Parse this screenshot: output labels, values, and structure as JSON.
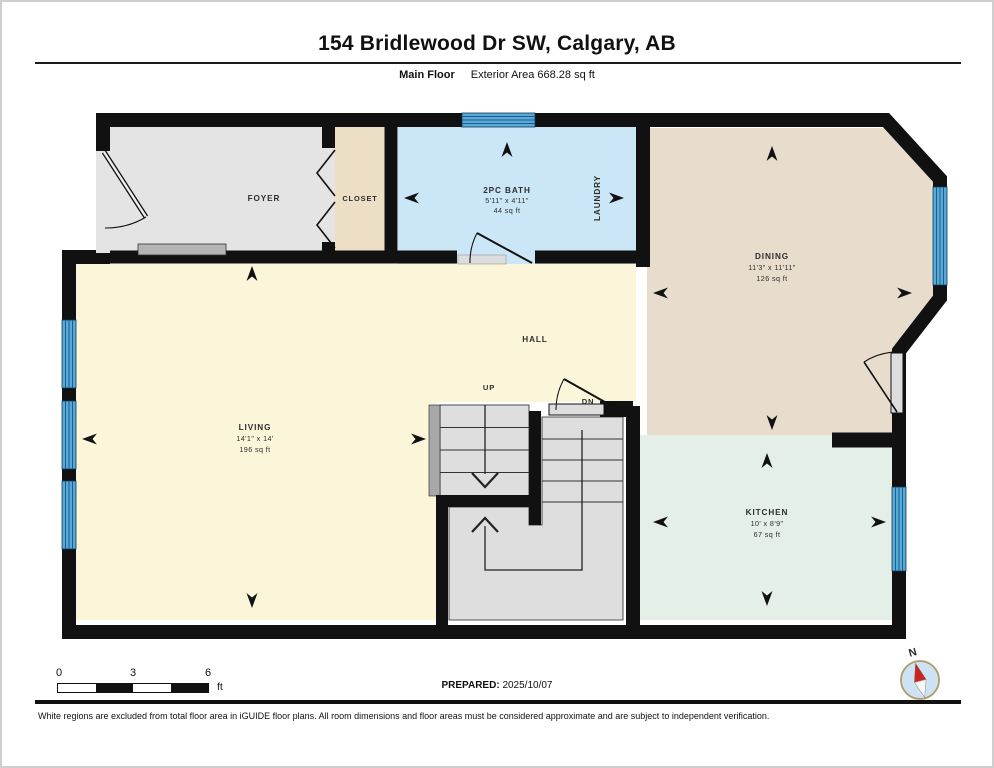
{
  "header": {
    "title": "154 Bridlewood Dr SW, Calgary, AB",
    "floor_label": "Main Floor",
    "area_label": "Exterior Area 668.28 sq ft"
  },
  "rooms": {
    "foyer": {
      "name": "FOYER"
    },
    "closet": {
      "name": "CLOSET"
    },
    "bath": {
      "name": "2PC BATH",
      "dims": "5'11\" x 4'11\"",
      "area": "44 sq ft"
    },
    "laundry": {
      "name": "LAUNDRY"
    },
    "dining": {
      "name": "DINING",
      "dims": "11'3\" x 11'11\"",
      "area": "126 sq ft"
    },
    "hall": {
      "name": "HALL"
    },
    "living": {
      "name": "LIVING",
      "dims": "14'1\" x 14'",
      "area": "196 sq ft"
    },
    "kitchen": {
      "name": "KITCHEN",
      "dims": "10' x 8'9\"",
      "area": "67 sq ft"
    },
    "stairs": {
      "up_label": "UP",
      "down_label": "DN"
    }
  },
  "scale_bar": {
    "t0": "0",
    "t3": "3",
    "t6": "6",
    "unit": "ft"
  },
  "compass": {
    "north_label": "N"
  },
  "footer": {
    "prepared_label": "PREPARED:",
    "prepared_date": "2025/10/07",
    "disclaimer": "White regions are excluded from total floor area in iGUIDE floor plans. All room dimensions and floor areas must be considered approximate and are subject to independent verification."
  },
  "colors": {
    "wall": "#111111",
    "window_blue": "#58a9d7",
    "window_line": "#1b5e8e",
    "bath_fill": "#cbe6f7",
    "dining_fill": "#e8ddcd",
    "kitchen_fill": "#e4efe7",
    "living_fill": "#fbf5da",
    "foyer_fill": "#e4e4e4",
    "closet_fill": "#ecdfc5",
    "stair_fill": "#dedede",
    "compass_needle": "#cc2222"
  }
}
